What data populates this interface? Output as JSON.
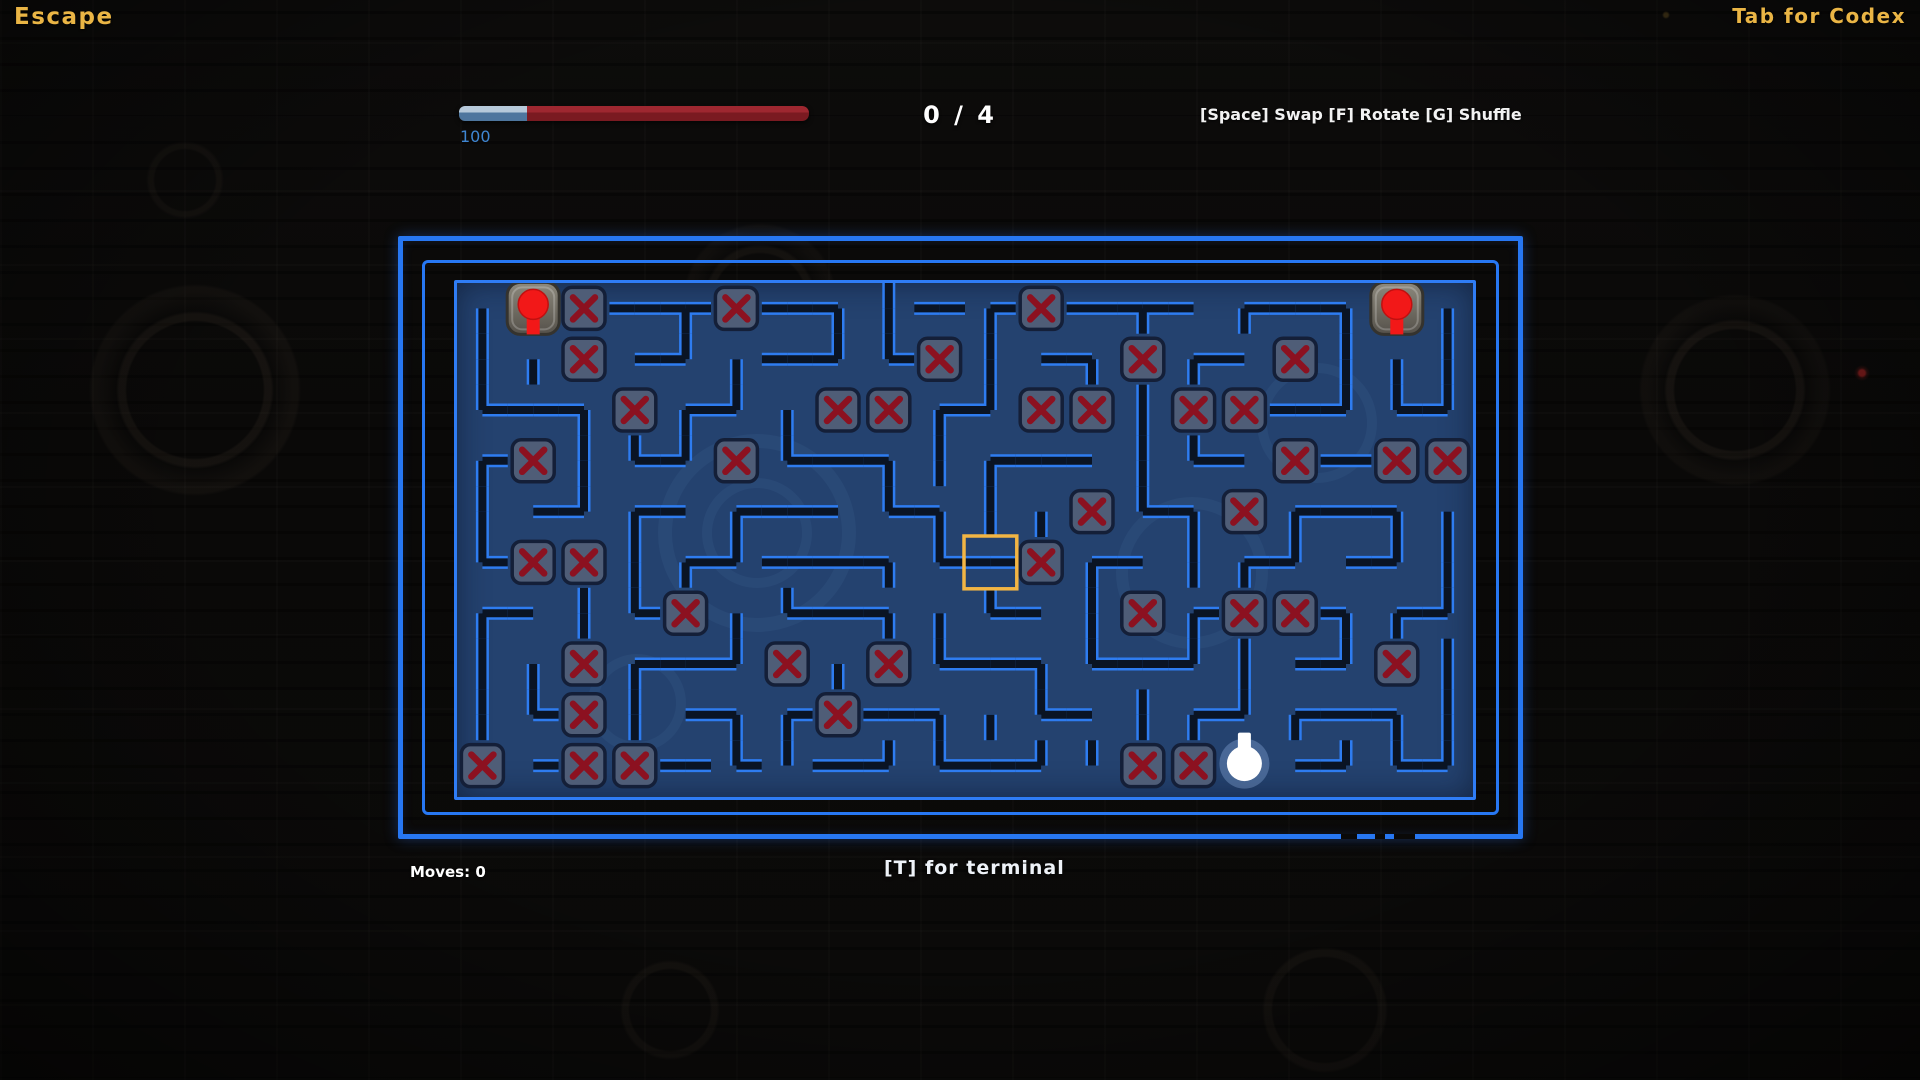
{
  "hud": {
    "escape_label": "Escape",
    "codex_label": "Tab for Codex",
    "health": {
      "value_label": "100",
      "percent": 19.5
    },
    "progress_label": "0 / 4",
    "controls_label": "[Space] Swap [F] Rotate [G] Shuffle",
    "moves_label": "Moves: 0",
    "terminal_label": "[T] for terminal"
  },
  "colors": {
    "accent_amber": "#eab545",
    "hp_blue": "#3f86d2",
    "hp_bar_blue": "#4e769e",
    "hp_bar_red": "#8e2127",
    "frame_blue": "#2777f2",
    "wall_edge": "#2e7cf0",
    "wall_core": "#0a1424",
    "play_bg": "#24426f",
    "tile_fill": "#4f5d77",
    "tile_border": "#141f38",
    "x_red": "#8c1120",
    "pin_red": "#f21818",
    "pin_tile_light": "#8d897d",
    "pin_tile_dark": "#55514a",
    "selection_gold": "#f2b544",
    "bulb_white": "#ffffff"
  },
  "maze": {
    "cols": 20,
    "rows": 10,
    "cell": 50.8,
    "selected_cell": {
      "col": 10,
      "row": 5
    },
    "pins": [
      {
        "col": 1,
        "row": 0
      },
      {
        "col": 18,
        "row": 0
      }
    ],
    "bulb": {
      "col": 15,
      "row": 9
    },
    "blocked_count": 39,
    "grid": [
      [
        "s",
        "p",
        "x",
        "ew",
        "sew",
        "x",
        "ew",
        "sw",
        "ns",
        "ew",
        "se",
        "x",
        "ew",
        "sew",
        "w",
        "se",
        "ew",
        "sw",
        "p",
        "s"
      ],
      [
        "ns",
        "s",
        "x",
        "e",
        "nw",
        "s",
        "ew",
        "nw",
        "ne",
        "x",
        "ns",
        "e",
        "sw",
        "x",
        "se",
        "w",
        "x",
        "ns",
        "s",
        "ns"
      ],
      [
        "ne",
        "ew",
        "sw",
        "x",
        "se",
        "nw",
        "s",
        "x",
        "x",
        "se",
        "nw",
        "x",
        "x",
        "ns",
        "x",
        "x",
        "ew",
        "nw",
        "ne",
        "nw"
      ],
      [
        "se",
        "x",
        "ns",
        "ne",
        "nw",
        "x",
        "ne",
        "ew",
        "sw",
        "ns",
        "se",
        "ew",
        "w",
        "ns",
        "ne",
        "w",
        "x",
        "ew",
        "x",
        "x"
      ],
      [
        "ns",
        "e",
        "nw",
        "se",
        "w",
        "se",
        "ew",
        "w",
        "ne",
        "sw",
        "ns",
        "s",
        "x",
        "ne",
        "sw",
        "x",
        "se",
        "ew",
        "sw",
        "s"
      ],
      [
        "ne",
        "x",
        "x",
        "ns",
        "se",
        "nw",
        "ew",
        "ew",
        "sw",
        "ne",
        "ew",
        "x",
        "se",
        "w",
        "ns",
        "se",
        "nw",
        "e",
        "nw",
        "ns"
      ],
      [
        "se",
        "w",
        "ns",
        "ne",
        "x",
        "s",
        "ne",
        "ew",
        "sw",
        "s",
        "ne",
        "w",
        "ns",
        "x",
        "se",
        "x",
        "x",
        "sw",
        "se",
        "nw"
      ],
      [
        "ns",
        "s",
        "x",
        "se",
        "ew",
        "nw",
        "x",
        "s",
        "x",
        "ne",
        "ew",
        "sw",
        "ne",
        "ew",
        "nw",
        "ns",
        "e",
        "nw",
        "x",
        "ns"
      ],
      [
        "ns",
        "ne",
        "x",
        "ns",
        "e",
        "sw",
        "se",
        "x",
        "ew",
        "sw",
        "s",
        "ne",
        "w",
        "ns",
        "se",
        "nw",
        "se",
        "ew",
        "sw",
        "ns"
      ],
      [
        "x",
        "e",
        "x",
        "x",
        "ew",
        "ne",
        "n",
        "ew",
        "nw",
        "ne",
        "ew",
        "nw",
        "n",
        "x",
        "x",
        "b",
        "e",
        "nw",
        "ne",
        "nw"
      ]
    ]
  }
}
